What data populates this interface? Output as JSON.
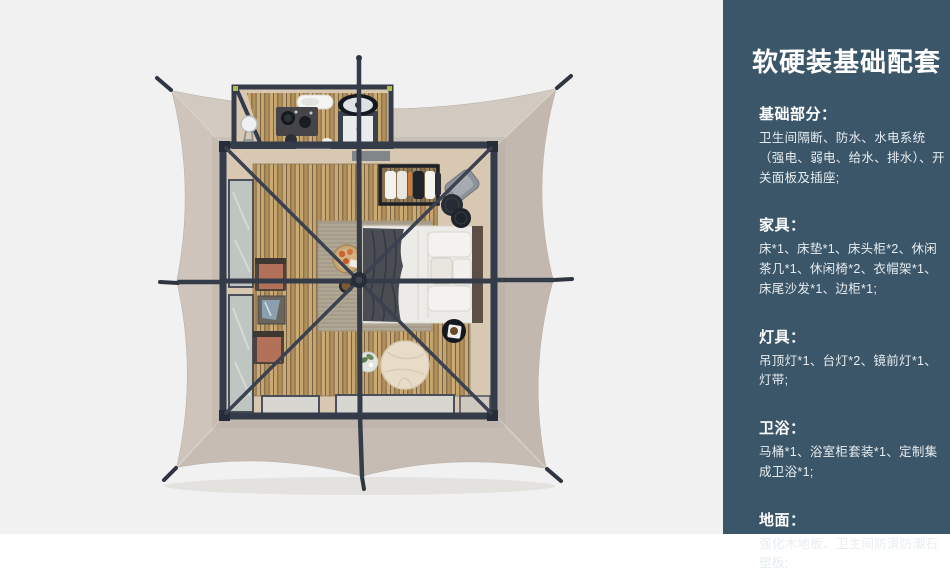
{
  "sidebar": {
    "bg": "#3b5668",
    "title": "软硬装基础配套",
    "sections": [
      {
        "title": "基础部分：",
        "body": "卫生间隔断、防水、水电系统（强电、弱电、给水、排水）、开关面板及插座;"
      },
      {
        "title": "家具：",
        "body": "床*1、床垫*1、床头柜*2、休闲茶几*1、休闲椅*2、衣帽架*1、床尾沙发*1、边柜*1;"
      },
      {
        "title": "灯具：",
        "body": "吊顶灯*1、台灯*2、镜前灯*1、灯带;"
      },
      {
        "title": "卫浴：",
        "body": "马桶*1、浴室柜套装*1、定制集成卫浴*1;"
      },
      {
        "title": "地面：",
        "body": "强化木地板、卫生间防滑防潮石塑板;"
      }
    ]
  },
  "plan": {
    "colors": {
      "background": "#f1f1f2",
      "canopy": "#cbc1b8",
      "canopy_top": "#d2c9c0",
      "canopy_right": "#c3b8af",
      "canopy_bottom": "#c7bcb3",
      "canopy_left": "#cec4bb",
      "frame": "#343b49",
      "cable": "#3a4150",
      "interior_wall": "#d8c8b2",
      "wood": "#c3a26c",
      "rug": "#aba08e",
      "window": "#bfc6c1",
      "bottom_window": "#d7d6d1",
      "bed_linen": "#edebe7",
      "throw": "#4a4d53",
      "headboard": "#5c5046",
      "chair": "#b4715a",
      "pouf": "#e8dcc8",
      "accent_lime": "#b5bc4e"
    }
  }
}
